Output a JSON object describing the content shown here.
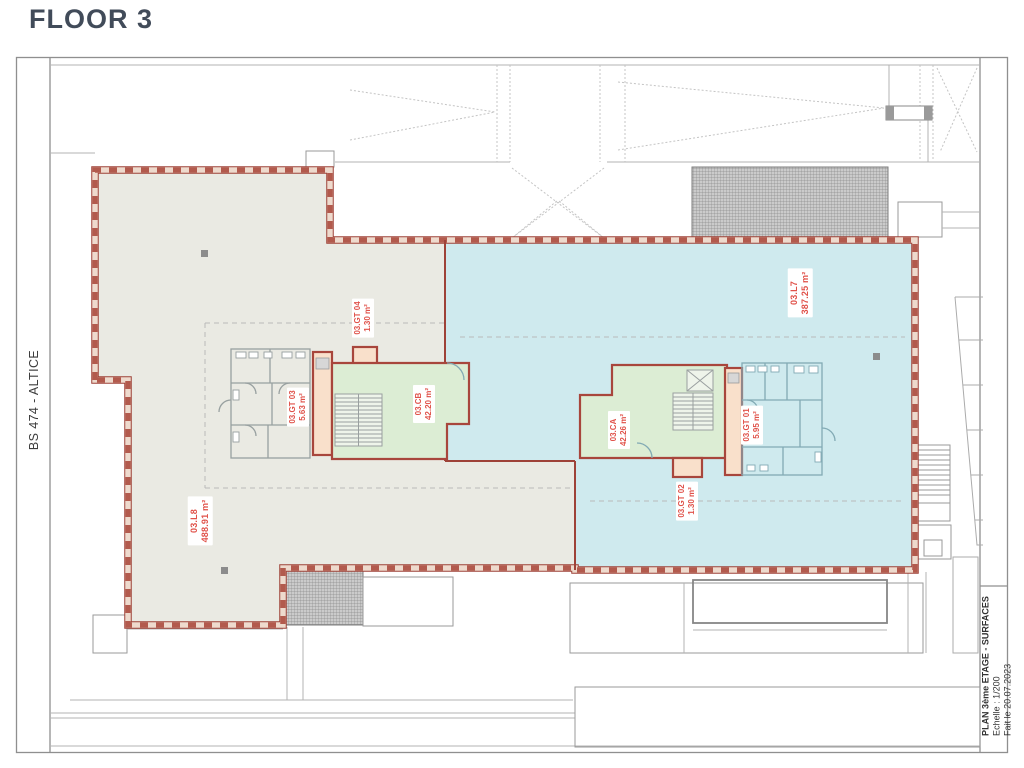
{
  "page": {
    "title": "FLOOR 3",
    "side_label": "BS 474 - ALTICE"
  },
  "title_block": {
    "line1": "PLAN 3ème ETAGE - SURFACES",
    "line2": "Echelle : 1/200",
    "line3": "Fait le 20.07.2023"
  },
  "rooms": [
    {
      "id": "03.L8",
      "area": "488.91 m²"
    },
    {
      "id": "03.L7",
      "area": "387.25 m²"
    },
    {
      "id": "03.CB",
      "area": "42.20 m²"
    },
    {
      "id": "03.CA",
      "area": "42.26 m²"
    },
    {
      "id": "03.GT 04",
      "area": "1.30 m²"
    },
    {
      "id": "03.GT 03",
      "area": "5.63 m²"
    },
    {
      "id": "03.GT 01",
      "area": "5.95 m²"
    },
    {
      "id": "03.GT 02",
      "area": "1.30 m²"
    }
  ],
  "colors": {
    "zone_l8_fill": "#eaeae3",
    "zone_l7_fill": "#cfeaee",
    "core_green_fill": "#dcedd4",
    "shaft_peach_fill": "#f9e0cb",
    "boundary_red": "#9e4238",
    "label_red": "#e0524a",
    "background_lines": "#b3b3b3"
  }
}
